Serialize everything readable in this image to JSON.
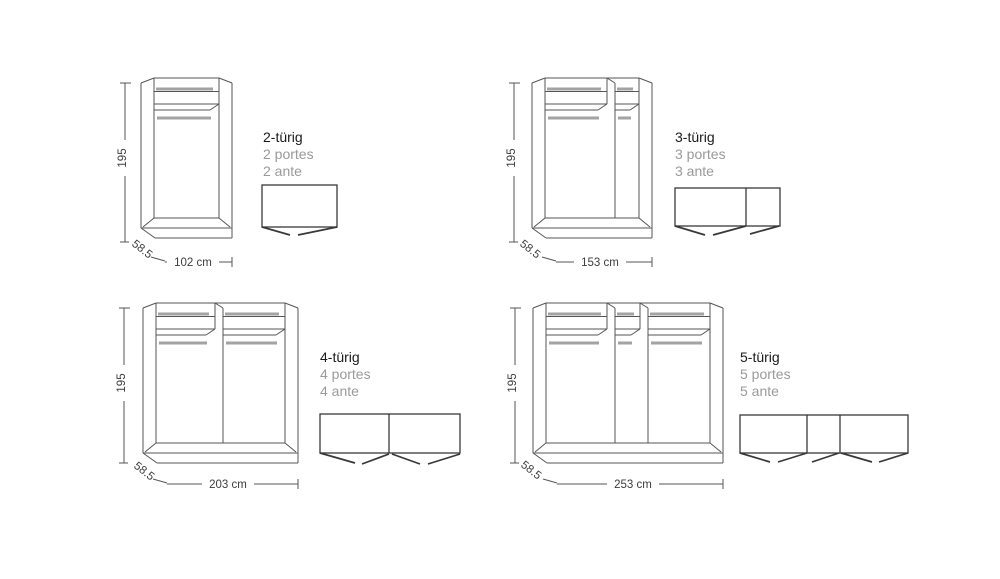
{
  "page": {
    "background": "#ffffff"
  },
  "colors": {
    "line": "#555555",
    "rail_gray": "#a3a3a3",
    "topview_line": "#383838",
    "title": "#1a1a1a",
    "subtitle": "#9a9a9a",
    "dim_text": "#3d3d3d"
  },
  "variants": [
    {
      "id": "2-tuerig",
      "door_count": 2,
      "label_de": "2-türig",
      "label_fr": "2 portes",
      "label_it": "2 ante",
      "height_label": "195",
      "depth_label": "58.5",
      "width_label": "102 cm",
      "width_cm": 102,
      "height_cm": 195,
      "depth_cm": 58.5,
      "drawing": {
        "front": {
          "x": 141,
          "y": 78,
          "w": 91,
          "h": 160,
          "dividers": [],
          "compartments": [
            [
              13,
              78
            ]
          ]
        },
        "top": {
          "x": 262,
          "y": 185,
          "w": 75,
          "h": 42,
          "dividers": [],
          "doors": [
            [
              0,
              42,
              28,
              50
            ],
            [
              36,
              50,
              75,
              42
            ]
          ]
        },
        "dims": {
          "vx": 125,
          "vtop": 83,
          "vbot": 242,
          "vtext_y": 158,
          "depth_cx": 140,
          "depth_cy": 252,
          "hy": 262,
          "htext_cx": 193
        },
        "title_pos": {
          "x": 263,
          "y": 129
        }
      }
    },
    {
      "id": "3-tuerig",
      "door_count": 3,
      "label_de": "3-türig",
      "label_fr": "3 portes",
      "label_it": "3 ante",
      "height_label": "195",
      "depth_label": "58.5",
      "width_label": "153 cm",
      "width_cm": 153,
      "height_cm": 195,
      "depth_cm": 58.5,
      "drawing": {
        "front": {
          "x": 532,
          "y": 78,
          "w": 120,
          "h": 160,
          "dividers": [
            83
          ],
          "compartments": [
            [
              13,
              75
            ],
            [
              83,
              107
            ]
          ]
        },
        "top": {
          "x": 675,
          "y": 188,
          "w": 105,
          "h": 38,
          "dividers": [
            71
          ],
          "doors": [
            [
              0,
              38,
              30,
              47
            ],
            [
              38,
              47,
              71,
              38
            ],
            [
              75,
              46,
              104,
              38
            ]
          ]
        },
        "dims": {
          "vx": 514,
          "vtop": 83,
          "vbot": 242,
          "vtext_y": 158,
          "depth_cx": 528,
          "depth_cy": 252,
          "hy": 262,
          "htext_cx": 600
        },
        "title_pos": {
          "x": 675,
          "y": 129
        }
      }
    },
    {
      "id": "4-tuerig",
      "door_count": 4,
      "label_de": "4-türig",
      "label_fr": "4 portes",
      "label_it": "4 ante",
      "height_label": "195",
      "depth_label": "58.5",
      "width_label": "203 cm",
      "width_cm": 203,
      "height_cm": 195,
      "depth_cm": 58.5,
      "drawing": {
        "front": {
          "x": 143,
          "y": 303,
          "w": 155,
          "h": 160,
          "dividers": [
            80
          ],
          "compartments": [
            [
              13,
              72
            ],
            [
              80,
              142
            ]
          ]
        },
        "top": {
          "x": 320,
          "y": 414,
          "w": 140,
          "h": 39,
          "dividers": [
            69
          ],
          "doors": [
            [
              0,
              39,
              35,
              49
            ],
            [
              42,
              50,
              69,
              40
            ],
            [
              72,
              40,
              100,
              50
            ],
            [
              108,
              50,
              140,
              40
            ]
          ]
        },
        "dims": {
          "vx": 124,
          "vtop": 308,
          "vbot": 463,
          "vtext_y": 383,
          "depth_cx": 142,
          "depth_cy": 474,
          "hy": 484,
          "htext_cx": 228
        },
        "title_pos": {
          "x": 320,
          "y": 349
        }
      }
    },
    {
      "id": "5-tuerig",
      "door_count": 5,
      "label_de": "5-türig",
      "label_fr": "5 portes",
      "label_it": "5 ante",
      "height_label": "195",
      "depth_label": "58.5",
      "width_label": "253 cm",
      "width_cm": 253,
      "height_cm": 195,
      "depth_cm": 58.5,
      "drawing": {
        "front": {
          "x": 533,
          "y": 303,
          "w": 190,
          "h": 160,
          "dividers": [
            82,
            115
          ],
          "compartments": [
            [
              13,
              74
            ],
            [
              82,
              107
            ],
            [
              115,
              177
            ]
          ]
        },
        "top": {
          "x": 740,
          "y": 415,
          "w": 168,
          "h": 38,
          "dividers": [
            67,
            100
          ],
          "doors": [
            [
              0,
              38,
              30,
              47
            ],
            [
              38,
              47,
              67,
              38
            ],
            [
              72,
              47,
              99,
              38
            ],
            [
              101,
              38,
              132,
              47
            ],
            [
              139,
              47,
              168,
              38
            ]
          ]
        },
        "dims": {
          "vx": 515,
          "vtop": 308,
          "vbot": 463,
          "vtext_y": 383,
          "depth_cx": 529,
          "depth_cy": 473,
          "hy": 484,
          "htext_cx": 633
        },
        "title_pos": {
          "x": 740,
          "y": 349
        }
      }
    }
  ]
}
